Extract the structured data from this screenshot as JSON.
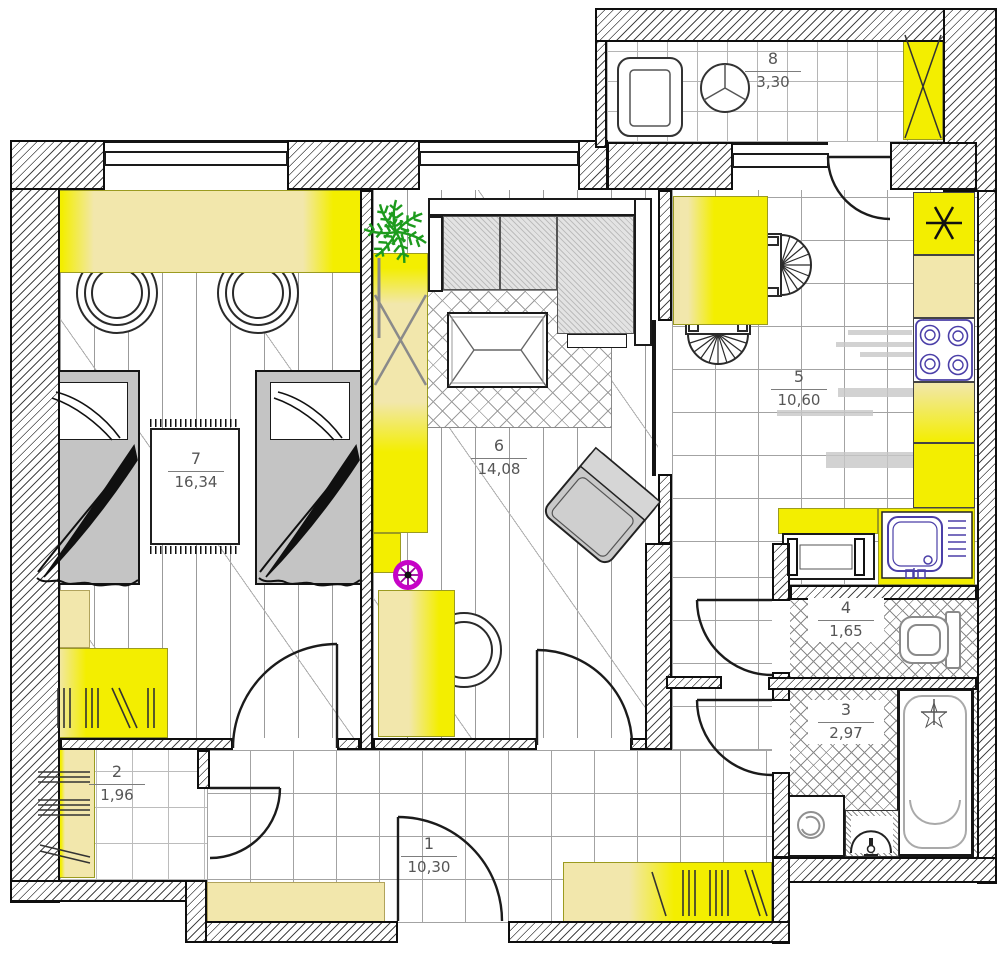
{
  "plan": {
    "title": "Apartment floor plan",
    "rooms": {
      "hall": {
        "name": "hallway",
        "number": "1",
        "area": "10,30"
      },
      "closet": {
        "name": "closet",
        "number": "2",
        "area": "1,96"
      },
      "bath": {
        "name": "bathroom",
        "number": "3",
        "area": "2,97"
      },
      "wc": {
        "name": "toilet-room",
        "number": "4",
        "area": "1,65"
      },
      "kitchen": {
        "name": "kitchen",
        "number": "5",
        "area": "10,60"
      },
      "living": {
        "name": "living-room",
        "number": "6",
        "area": "14,08"
      },
      "bedroom": {
        "name": "bedroom",
        "number": "7",
        "area": "16,34"
      },
      "balcony": {
        "name": "balcony",
        "number": "8",
        "area": "3,30"
      }
    },
    "colors": {
      "furniture_yellow": "#f3ee00",
      "furniture_pale_yellow": "#f2e7ac",
      "appliance_purple": "#4b3fa8",
      "stool_magenta": "#cc00cc",
      "plant_green": "#1d9b1d",
      "upholstery_gray": "#c9c9c9",
      "wall_black": "#0e0e0e"
    }
  }
}
